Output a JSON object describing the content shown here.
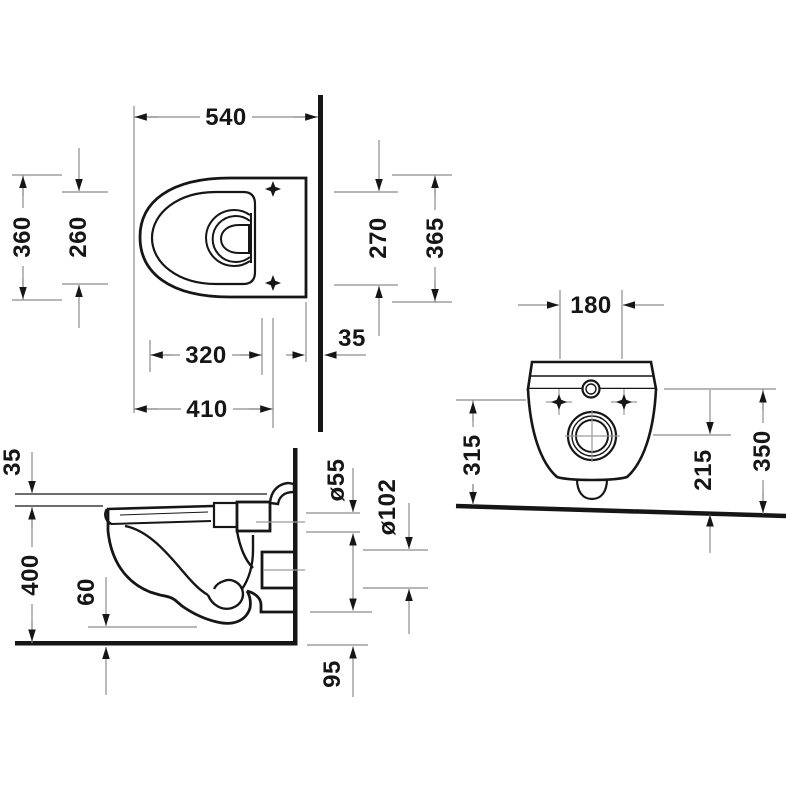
{
  "drawing": {
    "colors": {
      "outline": "#161616",
      "dimension_lines": "#8c8c8c",
      "background": "#ffffff"
    },
    "views": {
      "top": {
        "dims": {
          "d540": "540",
          "d360": "360",
          "d260": "260",
          "d270": "270",
          "d365": "365",
          "d35": "35",
          "d320": "320",
          "d410": "410"
        }
      },
      "side": {
        "dims": {
          "d35": "35",
          "d400": "400",
          "d60": "60",
          "d55": "ø55",
          "d102": "ø102",
          "d95": "95"
        }
      },
      "rear": {
        "dims": {
          "d180": "180",
          "d315": "315",
          "d215": "215",
          "d350": "350"
        }
      }
    }
  }
}
